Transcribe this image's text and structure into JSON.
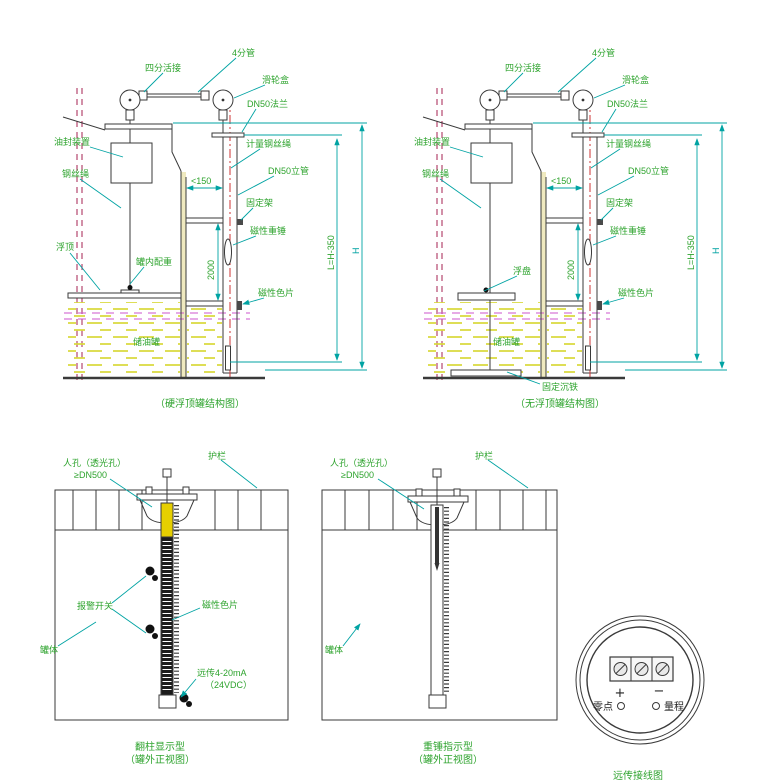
{
  "colors": {
    "label_green": "#2da32d",
    "dim_teal": "#00a3a3",
    "centerline_red": "#cc3333",
    "level_line_magenta": "#cc55cc",
    "liquid_yellow": "#d9d93e",
    "column_yellow": "#e6cf00"
  },
  "top_left": {
    "caption": "（硬浮顶罐结构图）",
    "labels": {
      "union": "四分活接",
      "pipe": "4分管",
      "pulley_box": "滑轮盒",
      "flange": "DN50法兰",
      "oil_seal": "油封装置",
      "wire_rope": "钢丝绳",
      "float_roof": "浮顶",
      "inner_weight": "罐内配重",
      "measure_rope": "计量钢丝绳",
      "riser": "DN50立管",
      "bracket": "固定架",
      "magnet_hammer": "磁性重锤",
      "magnet_chip": "磁性色片",
      "tank": "储油罐"
    },
    "dims": {
      "gap": "<150",
      "beam": "2000",
      "len": "L=H-350",
      "height": "H"
    }
  },
  "top_right": {
    "caption": "（无浮顶罐结构图）",
    "labels": {
      "union": "四分活接",
      "pipe": "4分管",
      "pulley_box": "滑轮盒",
      "flange": "DN50法兰",
      "oil_seal": "油封装置",
      "wire_rope": "钢丝绳",
      "float_plate": "浮盘",
      "anchor": "固定沉铁",
      "measure_rope": "计量钢丝绳",
      "riser": "DN50立管",
      "bracket": "固定架",
      "magnet_hammer": "磁性重锤",
      "magnet_chip": "磁性色片",
      "tank": "储油罐"
    },
    "dims": {
      "gap": "<150",
      "beam": "2000",
      "len": "L=H-350",
      "height": "H"
    }
  },
  "bottom_left": {
    "caption_line1": "翻柱显示型",
    "caption_line2": "（罐外正视图）",
    "labels": {
      "manhole": "人孔（透光孔）",
      "manhole_size": "≥DN500",
      "rail": "护栏",
      "alarm": "报警开关",
      "tank_body": "罐体",
      "chip": "磁性色片",
      "remote": "远传4-20mA",
      "vdc": "（24VDC）"
    }
  },
  "bottom_mid": {
    "caption_line1": "重锤指示型",
    "caption_line2": "（罐外正视图）",
    "labels": {
      "manhole": "人孔（透光孔）",
      "manhole_size": "≥DN500",
      "rail": "护栏",
      "tank_body": "罐体"
    }
  },
  "wiring": {
    "caption": "远传接线图",
    "plus": "+",
    "minus": "−",
    "zero": "零点",
    "span": "量程"
  }
}
